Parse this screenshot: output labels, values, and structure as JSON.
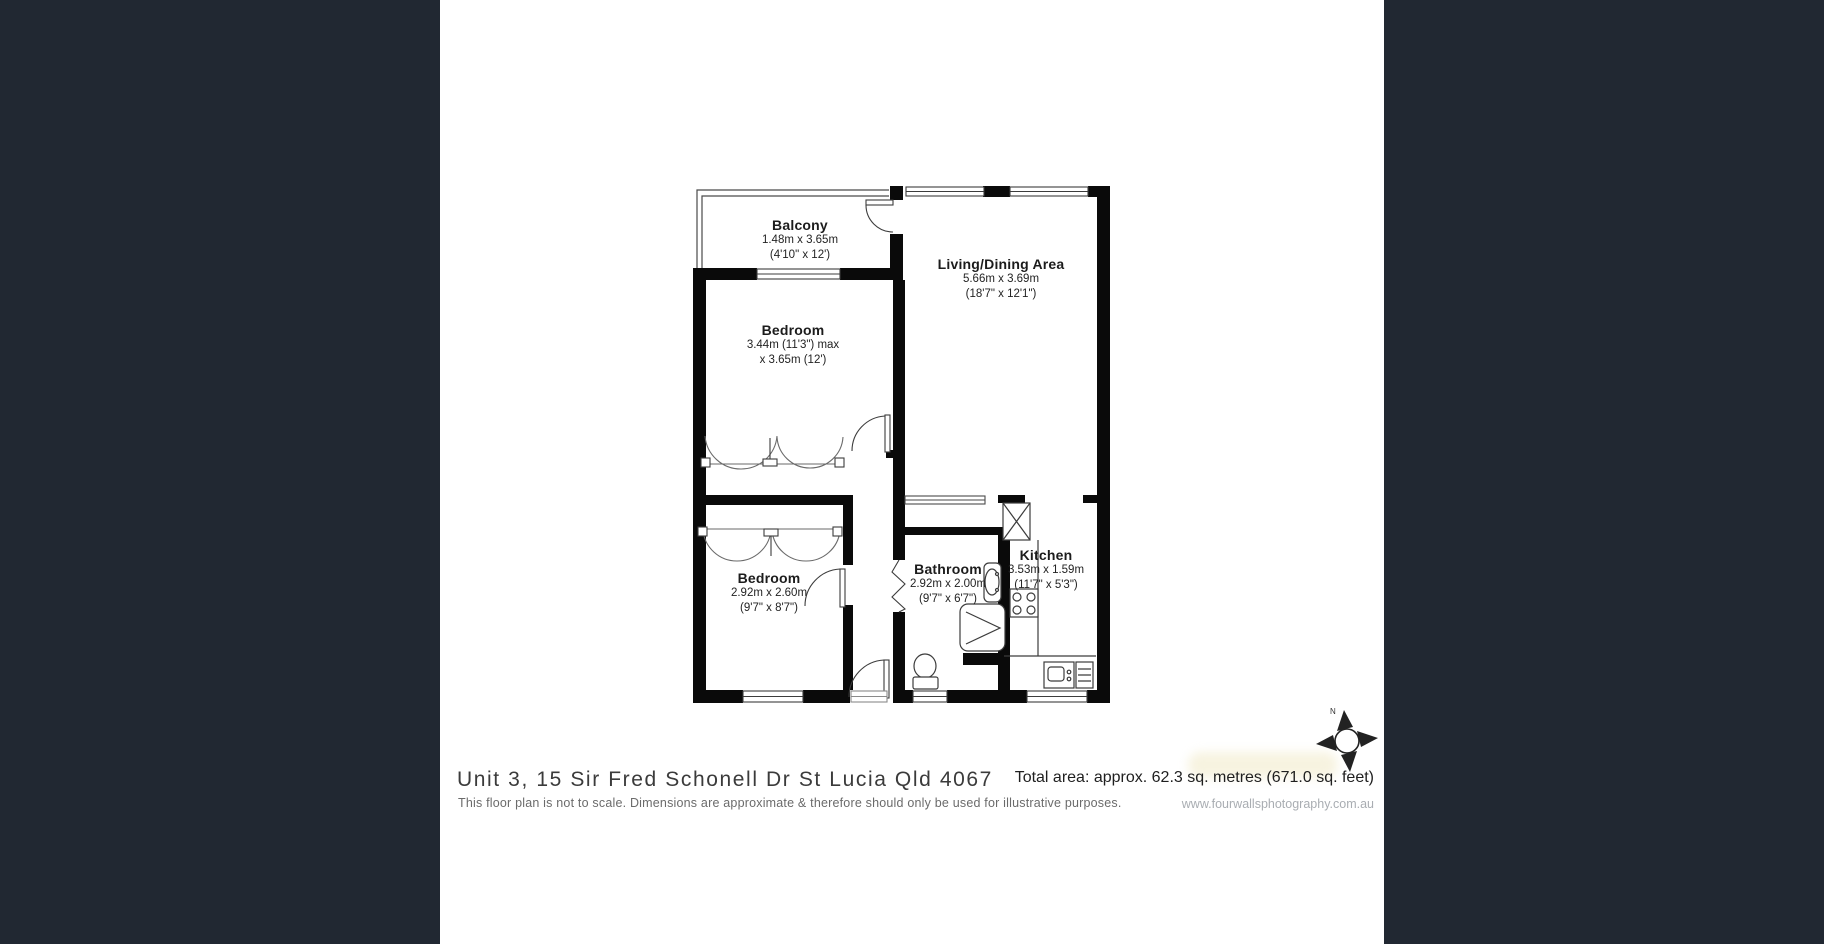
{
  "theme": {
    "sidebar_color": "#212832",
    "wall_color": "#0a0a0a",
    "line_color": "#3c3c3c",
    "background": "#ffffff"
  },
  "floorplan": {
    "compass_label": "N",
    "rooms": [
      {
        "id": "balcony",
        "name": "Balcony",
        "dim_line1": "1.48m x 3.65m",
        "dim_line2": "(4'10\" x 12')"
      },
      {
        "id": "living",
        "name": "Living/Dining Area",
        "dim_line1": "5.66m x 3.69m",
        "dim_line2": "(18'7\" x 12'1\")"
      },
      {
        "id": "bedroom1",
        "name": "Bedroom",
        "dim_line1": "3.44m (11'3\") max",
        "dim_line2": "x 3.65m (12')"
      },
      {
        "id": "bedroom2",
        "name": "Bedroom",
        "dim_line1": "2.92m x 2.60m",
        "dim_line2": "(9'7\" x 8'7\")"
      },
      {
        "id": "bathroom",
        "name": "Bathroom",
        "dim_line1": "2.92m x 2.00m",
        "dim_line2": "(9'7\" x 6'7\")"
      },
      {
        "id": "kitchen",
        "name": "Kitchen",
        "dim_line1": "3.53m x 1.59m",
        "dim_line2": "(11'7\" x 5'3\")"
      }
    ]
  },
  "footer": {
    "address": "Unit 3, 15 Sir Fred Schonell Dr St Lucia Qld 4067",
    "disclaimer": "This floor plan is not to scale. Dimensions are approximate & therefore should only be used for illustrative purposes.",
    "total_area": "Total area: approx. 62.3 sq. metres (671.0 sq. feet)",
    "website": "www.fourwallsphotography.com.au"
  }
}
